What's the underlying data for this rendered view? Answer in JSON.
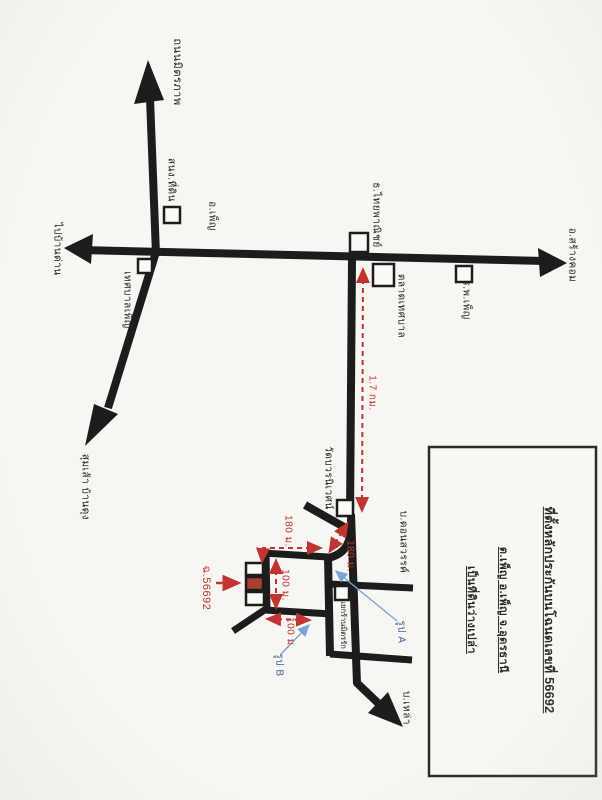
{
  "map": {
    "title_context": "scanned hand-drawn location map, Phen district, Udon Thani",
    "labels": {
      "road_north": "ถนนมิตรภาพ",
      "land_office": "สนง.ที่ดิน",
      "district_office": "อ.เพ็ญ",
      "municipality": "เทศบาลเพ็ญ",
      "to_ban_dan": "ไปบ้านด่าน",
      "to_sang_khom": "อ.สร้างคอม",
      "to_sumsao_bandung": "สุมเส้า บ้านดุง",
      "bank_scb": "ธ.ไทยพาณิชย์",
      "market": "ตลาดเทศบาล",
      "hospital": "ร.พ.เพ็ญ",
      "temple": "วัดบวรนิเวศน์",
      "village_don_sawan": "บ.ดอนสวรรค์",
      "junction_shop": "แยกร้านมิตรรัก",
      "village_lao": "บ.เหล่า"
    },
    "distances": {
      "main_leg": "1.7 กม.",
      "curve_leg": "180 ม.",
      "west_leg": "180 ม.",
      "north_side": "100 ม.",
      "south_side": "100 ม."
    },
    "deed_pointer": "ฉ.56692",
    "photos": {
      "a": "รูป A",
      "b": "รูป B"
    },
    "info_box": {
      "line1": "ที่ตั้งหลักประกันบนโฉนดเลขที่ 56692",
      "line2": "ต.เพ็ญ อ.เพ็ญ จ.อุดรธานี",
      "line3": "เป็นที่ดินว่างเปล่า"
    },
    "colors": {
      "road": "#1c1c1c",
      "route_red": "#c23430",
      "parcel_fill": "#a8402f",
      "photo_arrow_blue": "#7aa3d8",
      "paper": "#f7f6f2"
    }
  }
}
